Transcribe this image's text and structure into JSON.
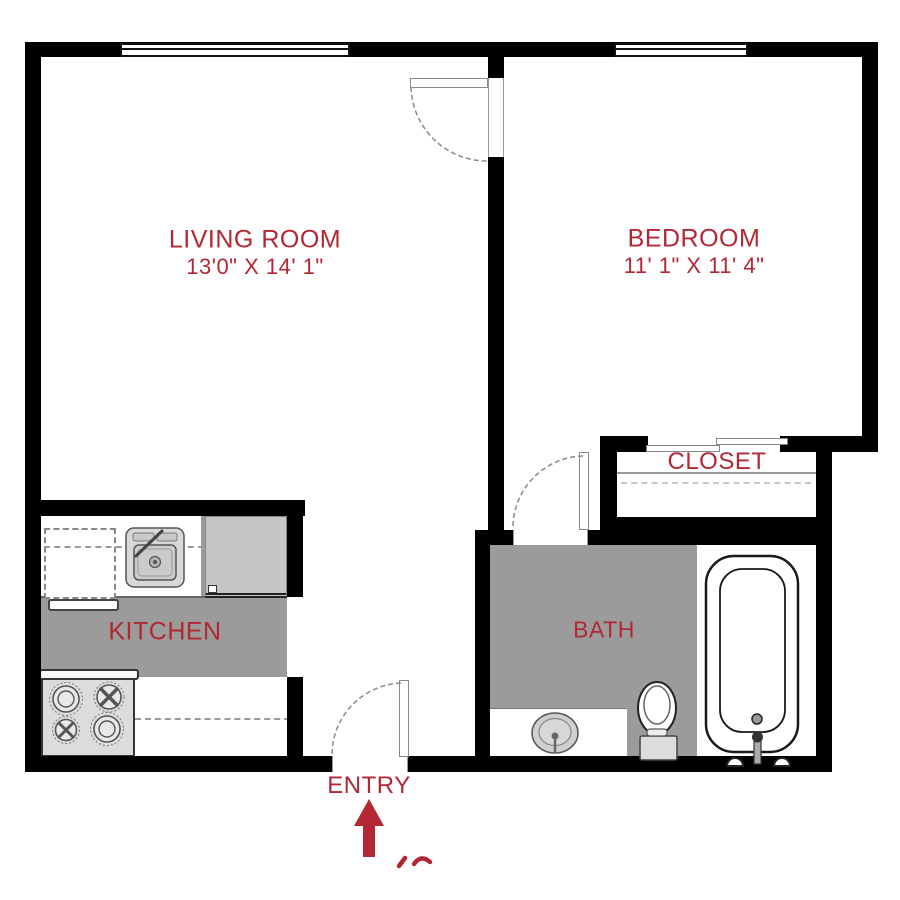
{
  "rooms": {
    "living_room": {
      "label": "LIVING ROOM",
      "dims": "13'0\" X 14' 1\""
    },
    "bedroom": {
      "label": "BEDROOM",
      "dims": "11' 1\" X 11' 4\""
    },
    "closet": {
      "label": "CLOSET"
    },
    "kitchen": {
      "label": "KITCHEN"
    },
    "bath": {
      "label": "BATH"
    },
    "entry": {
      "label": "ENTRY"
    }
  },
  "colors": {
    "label_red": "#B22734",
    "wall_black": "#000000",
    "floor_gray": "#9B9B9B",
    "appliance_gray": "#DCDCDC"
  },
  "fixtures": [
    "living-room-window",
    "bedroom-window",
    "bedroom-door",
    "bath-door",
    "entry-door",
    "closet-sliding-doors",
    "closet-shelf",
    "kitchen-sink",
    "refrigerator",
    "stove",
    "dishwasher-space",
    "counter",
    "bathtub",
    "toilet",
    "bathroom-sink",
    "vanity"
  ],
  "annotations": {
    "entry_arrow": "up-arrow",
    "partial_text": "cropped red text fragment"
  }
}
